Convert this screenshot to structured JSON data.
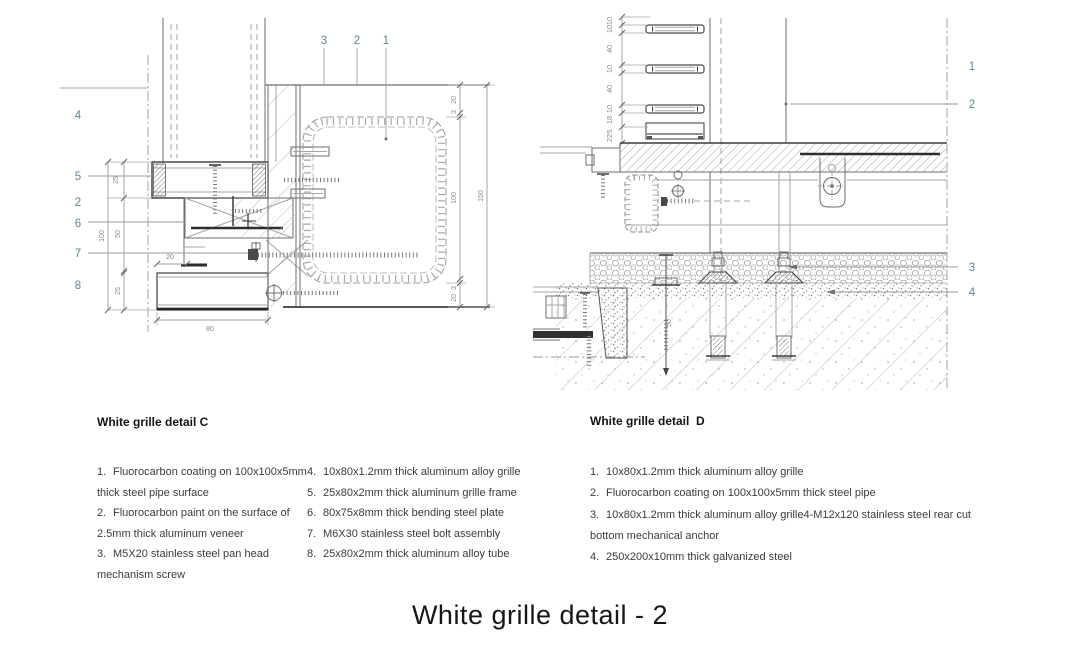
{
  "page": {
    "title": "White grille detail - 2"
  },
  "colors": {
    "callout": "#5d8593",
    "dim_text": "#8a8a8a",
    "line_dark": "#3c3c3c",
    "line_light": "#a5a5a5"
  },
  "detail_c": {
    "heading": "White grille detail C",
    "callouts_top": [
      "3",
      "2",
      "1"
    ],
    "callouts_left": [
      "4",
      "5",
      "2",
      "6",
      "7",
      "8"
    ],
    "dims_left": {
      "d25_top": "25",
      "d100": "100",
      "d50": "50",
      "d20": "20",
      "d25_bottom": "25",
      "d80": "80"
    },
    "dims_right": {
      "d20_top": "20",
      "d3_top": "3",
      "d100": "100",
      "d3_bottom": "3",
      "d20_bottom": "20",
      "d150": "150"
    },
    "legend_col1": [
      {
        "num": "1.",
        "text": "Fluorocarbon coating on 100x100x5mm thick steel pipe surface"
      },
      {
        "num": "2.",
        "text": "Fluorocarbon paint on the surface of 2.5mm thick aluminum veneer"
      },
      {
        "num": "3.",
        "text": "M5X20 stainless steel pan head mechanism screw"
      }
    ],
    "legend_col2": [
      {
        "num": "4.",
        "text": "10x80x1.2mm thick aluminum alloy grille"
      },
      {
        "num": "5.",
        "text": "25x80x2mm thick aluminum grille frame"
      },
      {
        "num": "6.",
        "text": "80x75x8mm thick bending steel plate"
      },
      {
        "num": "7.",
        "text": "M6X30 stainless steel bolt assembly"
      },
      {
        "num": "8.",
        "text": "25x80x2mm thick aluminum alloy tube"
      }
    ]
  },
  "detail_d": {
    "heading": "White grille detail  D",
    "callouts_right": [
      "1",
      "2",
      "3",
      "4"
    ],
    "dims_left": [
      "10",
      "10",
      "40",
      "10",
      "40",
      "10",
      "18",
      "225"
    ],
    "dim_extra": "50",
    "legend": [
      {
        "num": "1.",
        "text": "10x80x1.2mm thick aluminum alloy grille"
      },
      {
        "num": "2.",
        "text": "Fluorocarbon coating on 100x100x5mm thick steel pipe"
      },
      {
        "num": "3.",
        "text": "10x80x1.2mm thick aluminum alloy grille4-M12x120 stainless steel rear cut bottom mechanical anchor"
      },
      {
        "num": "4.",
        "text": "250x200x10mm thick galvanized steel"
      }
    ]
  }
}
